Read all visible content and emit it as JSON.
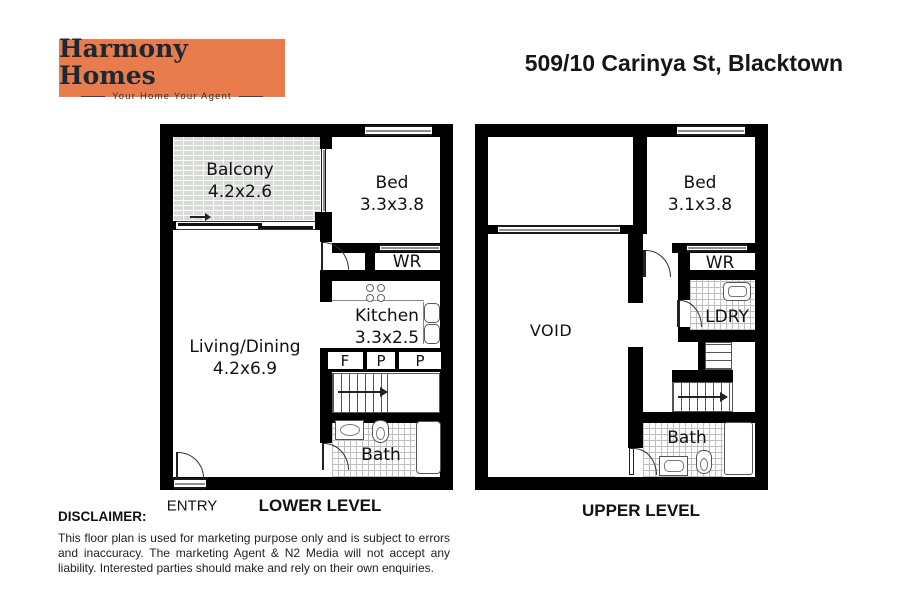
{
  "header": {
    "logo": {
      "title": "Harmony Homes",
      "tagline": "Your Home Your Agent",
      "bg_color": "#E87C4D"
    },
    "address": "509/10 Carinya St, Blacktown"
  },
  "lower_level": {
    "caption": "LOWER LEVEL",
    "entry": "ENTRY",
    "balcony": {
      "name": "Balcony",
      "dims": "4.2x2.6"
    },
    "bed": {
      "name": "Bed",
      "dims": "3.3x3.8"
    },
    "wr": "WR",
    "kitchen": {
      "name": "Kitchen",
      "dims": "3.3x2.5"
    },
    "living": {
      "name": "Living/Dining",
      "dims": "4.2x6.9"
    },
    "bath": "Bath",
    "fpp": [
      "F",
      "P",
      "P"
    ]
  },
  "upper_level": {
    "caption": "UPPER LEVEL",
    "bed": {
      "name": "Bed",
      "dims": "3.1x3.8"
    },
    "wr": "WR",
    "ldry": "LDRY",
    "void": "VOID",
    "bath": "Bath"
  },
  "disclaimer": {
    "title": "DISCLAIMER:",
    "body": "This floor plan is used for marketing purpose only and is subject to errors and inaccuracy. The marketing Agent & N2 Media will not accept any liability. Interested parties should make and rely on their own enquiries."
  },
  "colors": {
    "wall": "#000000",
    "balcony_fill": "#d7dad7",
    "logo_orange": "#E87C4D"
  }
}
